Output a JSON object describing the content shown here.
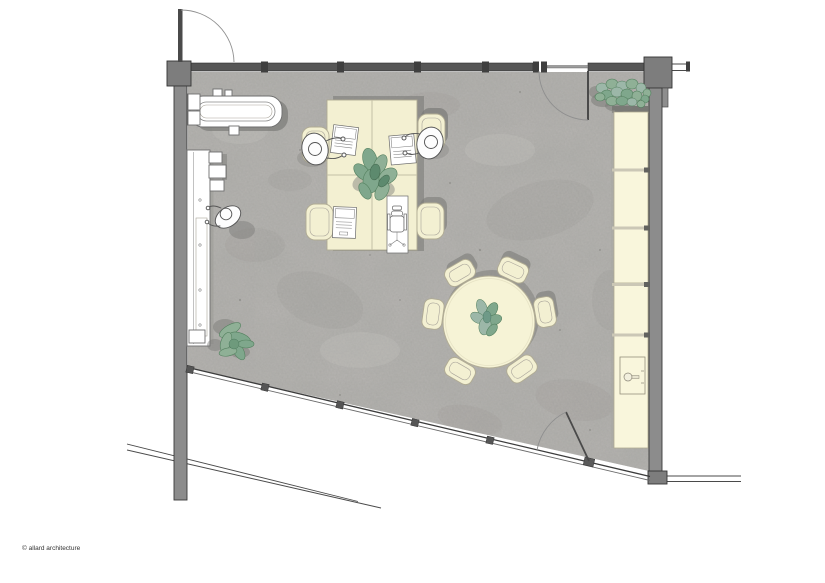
{
  "document": {
    "kind": "architectural floor plan - office interior, top view",
    "copyright": "© allard architecture"
  },
  "colors": {
    "bg": "#ffffff",
    "wall": "#8c8c8c",
    "wall-dark": "#565656",
    "wall-edge": "#3a3a3a",
    "floor": "#b5b3b0",
    "cream": "#f3f0d2",
    "cream-light": "#f9f6dc",
    "cream-stroke": "#b0ab93",
    "white": "#ffffff",
    "shadow": "#7b7b78",
    "plant": "#8fb096",
    "plant-2": "#7fa78c",
    "plant-3": "#9cb7a8",
    "plant-dark": "#54805f",
    "text": "#333333"
  },
  "plan": {
    "room": {
      "shape": "quadrilateral room, bottom facade angled",
      "doors": 3,
      "glazed_walls": 2
    },
    "elements": {
      "sofa_top_left": "sofa with side tables",
      "counter_left_wall": "long counter with appliances",
      "standing_people": 1,
      "workstation_cluster": {
        "desks": 4,
        "chairs": 4,
        "seated_people": 2,
        "laptops": 3,
        "empty_chair_symbol": 1,
        "plant": 1
      },
      "round_meeting_table": {
        "chairs": 6,
        "plant": 1
      },
      "storage_right_wall": {
        "cabinet_units": 5,
        "sink_unit": 1
      },
      "floor_plants": 2
    }
  }
}
